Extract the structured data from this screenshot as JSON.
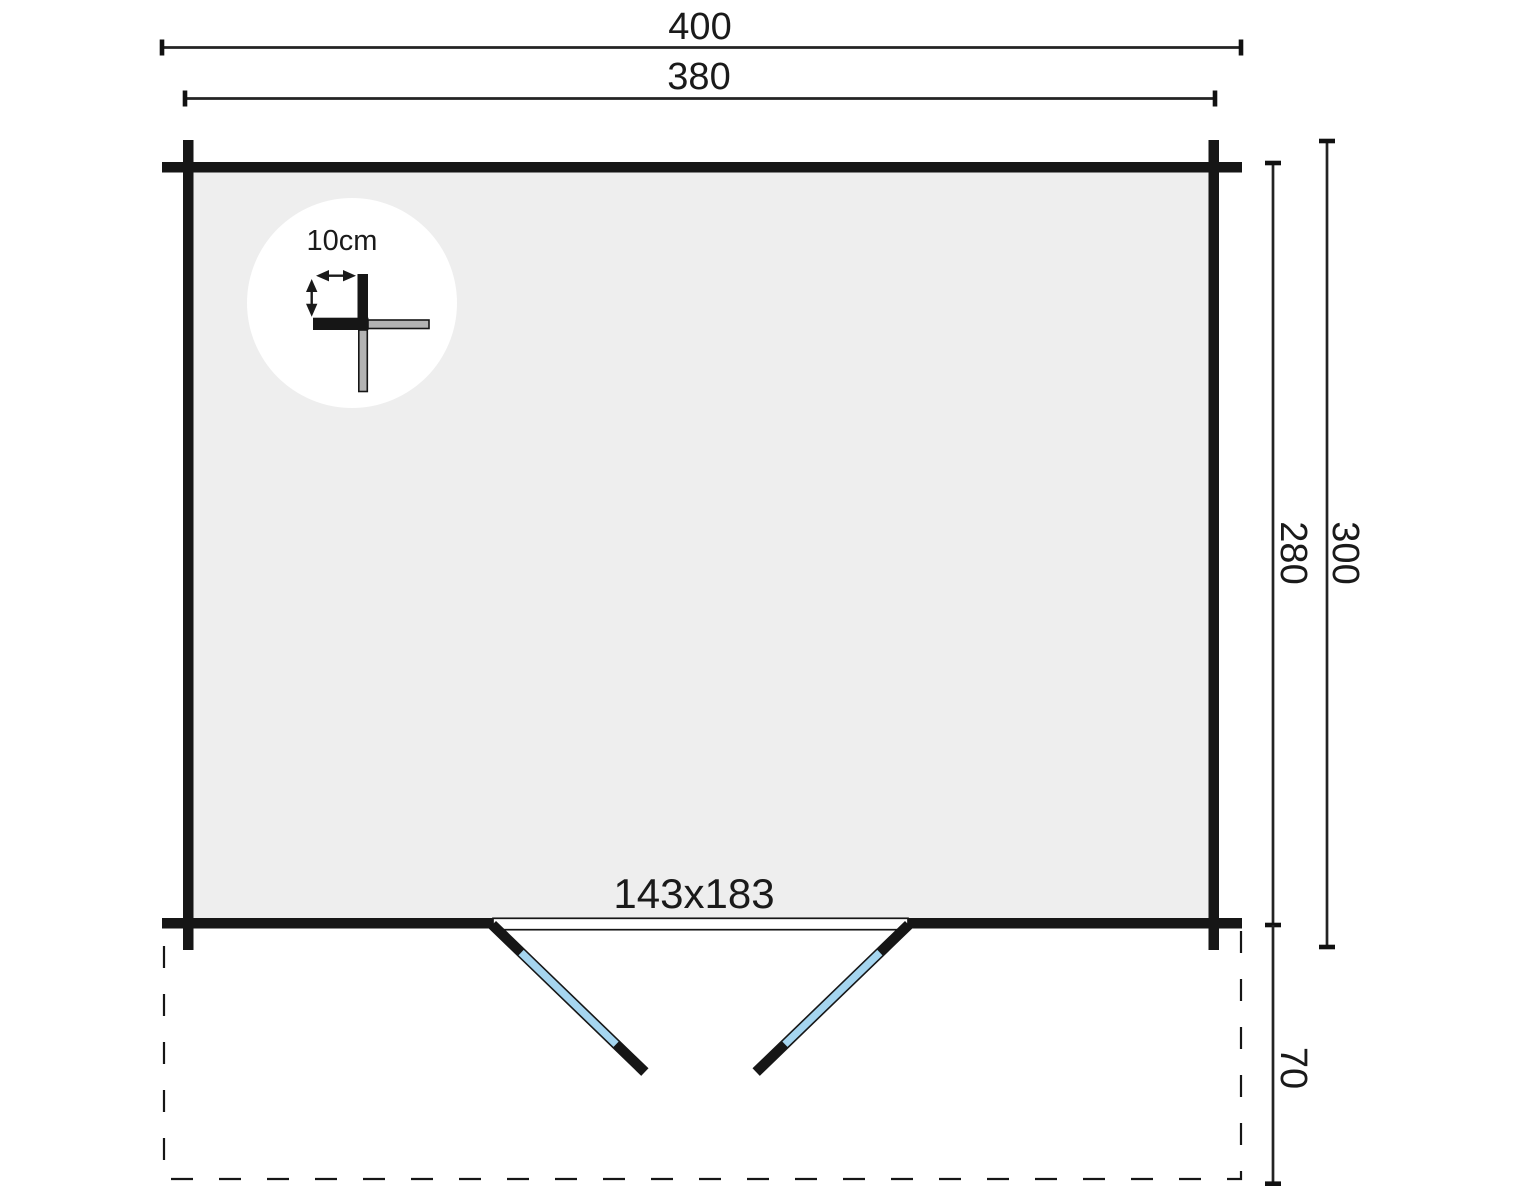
{
  "labels": {
    "outer_width": "400",
    "inner_width": "380",
    "inner_depth": "280",
    "outer_depth": "300",
    "terrace_depth": "70",
    "door_size": "143x183",
    "wall_thickness": "10cm"
  },
  "colors": {
    "wall": "#161616",
    "floor": "#eeeeee",
    "door_glass": "#a5d5ef",
    "detail_gray": "#b3b3b3",
    "detail_circle": "#ffffff"
  }
}
